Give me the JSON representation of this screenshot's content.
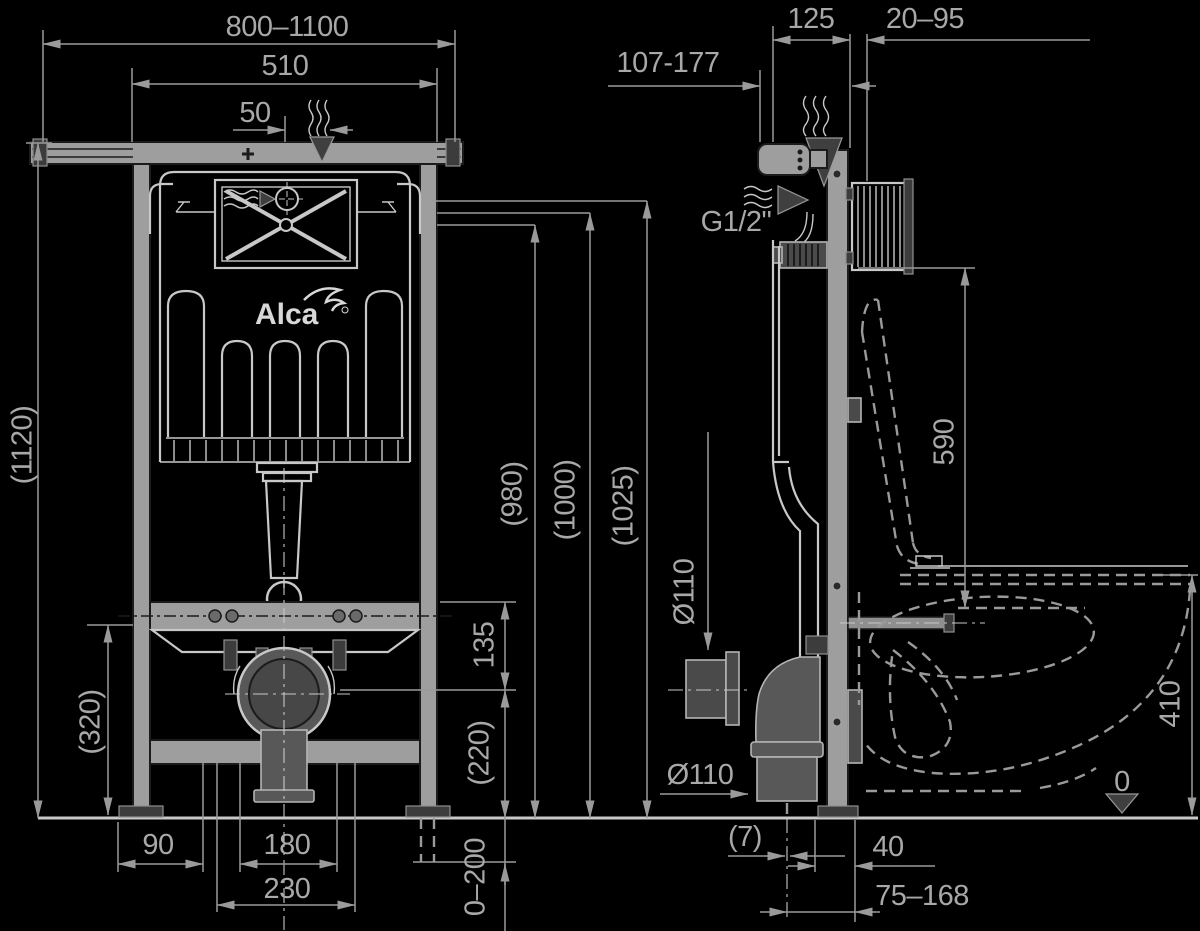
{
  "brand": {
    "logo": "Alca"
  },
  "front": {
    "dims": {
      "rail_width": "800–1100",
      "frame_width": "510",
      "center_offset": "50",
      "total_height": "(1120)",
      "lower_frame_height": "(320)",
      "height_980": "(980)",
      "height_1000": "(1000)",
      "height_1025": "(1025)",
      "bracket_to_outlet": "135",
      "outlet_height": "(220)",
      "foot_extension": "0–200",
      "foot_offset": "90",
      "stud_spacing": "180",
      "stud_outer_spacing": "230"
    }
  },
  "side": {
    "dims": {
      "plate_depth": "107-177",
      "frame_depth": "125",
      "wall_finish": "20–95",
      "water_connection": "G1/2\"",
      "bracket_to_seat": "590",
      "seat_height": "410",
      "floor_level": "0",
      "inlet_diameter": "Ø110",
      "outlet_diameter": "Ø110",
      "outlet_center_offset": "(7)",
      "outlet_to_wall": "40",
      "outlet_range": "75–168"
    }
  }
}
